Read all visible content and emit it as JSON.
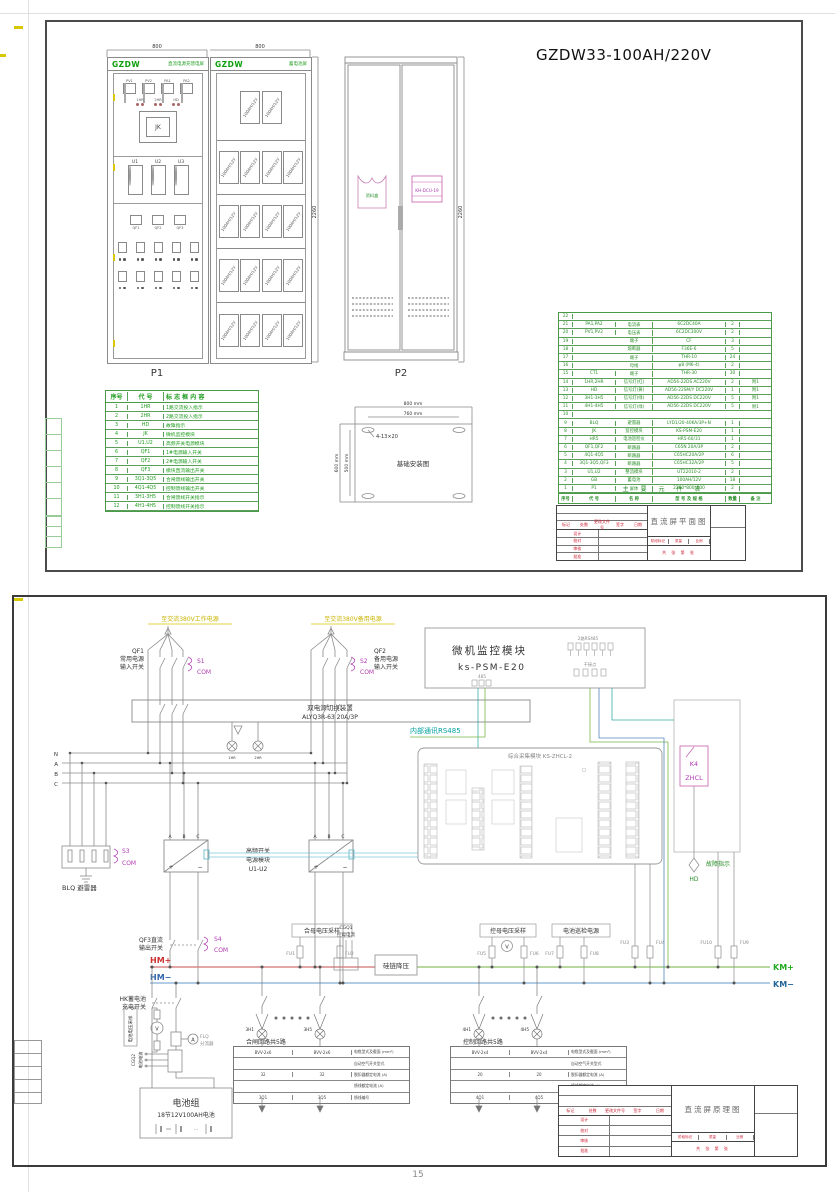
{
  "page": {
    "number": "15"
  },
  "tb_common": {
    "rev": [
      "标记",
      "处数",
      "更改文件号",
      "签字",
      "日期"
    ],
    "roles": [
      "设计",
      "校对",
      "审核",
      "批准"
    ],
    "stage": [
      "阶段标记",
      "质量",
      "比例"
    ],
    "sheets": "共 张  第 张"
  },
  "sheet1": {
    "main_title": "GZDW33-100AH/220V",
    "dim_800_left": "800",
    "dim_800_right": "800",
    "dim_2260_bat": "2260",
    "dim_2260_p2": "2260",
    "p1": {
      "brand": "GZDW",
      "header": "直流电源充馈电屏",
      "label": "P1",
      "meters": [
        "PV1",
        "PV2",
        "PA1",
        "PA2"
      ],
      "lamps": [
        "1HR",
        "2HR",
        "HD"
      ],
      "jk": "JK",
      "modules": [
        "U1",
        "U2",
        "U3"
      ],
      "breakers": [
        "QF1",
        "QF2",
        "QF3"
      ]
    },
    "bat": {
      "brand": "GZDW",
      "header": "蓄电池屏",
      "row1": [
        "100AH/12V",
        "100AH/12V"
      ],
      "row2": [
        "100AH/12V",
        "100AH/12V",
        "100AH/12V",
        "100AH/12V"
      ],
      "row3": [
        "100AH/12V",
        "100AH/12V",
        "100AH/12V",
        "100AH/12V"
      ],
      "row4": [
        "100AH/12V",
        "100AH/12V",
        "100AH/12V",
        "100AH/12V"
      ],
      "row5": [
        "100AH/12V",
        "100AH/12V",
        "100AH/12V",
        "100AH/12V"
      ]
    },
    "p2": {
      "label": "P2",
      "pocket": "资料盒",
      "dcu": "KH-DCU-19"
    },
    "marking": {
      "headers": [
        "序号",
        "代 号",
        "标 志 框 内 容"
      ],
      "rows": [
        {
          "n": "1",
          "c": "1HR",
          "d": "1路交流投入指示"
        },
        {
          "n": "2",
          "c": "2HR",
          "d": "2路交流投入指示"
        },
        {
          "n": "3",
          "c": "HD",
          "d": "故障指示"
        },
        {
          "n": "4",
          "c": "JK",
          "d": "微机监控模块"
        },
        {
          "n": "5",
          "c": "U1,U2",
          "d": "高频开关电源模块"
        },
        {
          "n": "6",
          "c": "QF1",
          "d": "1#电源输入开关"
        },
        {
          "n": "7",
          "c": "QF2",
          "d": "2#电源输入开关"
        },
        {
          "n": "8",
          "c": "QF3",
          "d": "模块直流输出开关"
        },
        {
          "n": "9",
          "c": "3Q1-3Q5",
          "d": "合闸馈线输出开关"
        },
        {
          "n": "10",
          "c": "4Q1-4Q5",
          "d": "控制馈线输出开关"
        },
        {
          "n": "11",
          "c": "3H1-3H5",
          "d": "合闸馈线开关指示"
        },
        {
          "n": "12",
          "c": "4H1-4H5",
          "d": "控制馈线开关指示"
        }
      ]
    },
    "foundation": {
      "title": "基础安装图",
      "d1": "800 mm",
      "d2": "760 mm",
      "d3": "600 mm",
      "d4": "500 mm",
      "callout": "4-13×20"
    },
    "parts": {
      "caption": "主 要 元 件 表",
      "headers": [
        "序号",
        "代  号",
        "名  称",
        "型 号 及 规 格",
        "数量",
        "备 注"
      ],
      "rows": [
        {
          "n": "22",
          "c": "",
          "m": "",
          "t": "",
          "q": "",
          "r": ""
        },
        {
          "n": "21",
          "c": "PA1,PA2",
          "m": "电流表",
          "t": "6C2DC40A",
          "q": "2",
          "r": ""
        },
        {
          "n": "20",
          "c": "PV1,PV2",
          "m": "电压表",
          "t": "6C2DC300V",
          "q": "2",
          "r": ""
        },
        {
          "n": "19",
          "c": "",
          "m": "端子",
          "t": "CF",
          "q": "3",
          "r": ""
        },
        {
          "n": "18",
          "c": "",
          "m": "熔断器",
          "t": "F36E-6",
          "q": "5",
          "r": ""
        },
        {
          "n": "17",
          "c": "",
          "m": "端子",
          "t": "THR-10",
          "q": "24",
          "r": ""
        },
        {
          "n": "16",
          "c": "",
          "m": "母线",
          "t": "φ8 (M6-4)",
          "q": "2",
          "r": ""
        },
        {
          "n": "15",
          "c": "CT1",
          "m": "端子",
          "t": "THR-30",
          "q": "30",
          "r": ""
        },
        {
          "n": "14",
          "c": "1HR,2HR",
          "m": "信号灯(红)",
          "t": "AD56-22DS AC220V",
          "q": "2",
          "r": "附1"
        },
        {
          "n": "13",
          "c": "HD",
          "m": "信号灯(黄)",
          "t": "AD56-22SM/Y DC220V",
          "q": "1",
          "r": "附1"
        },
        {
          "n": "12",
          "c": "3H1-3H5",
          "m": "信号灯(绿)",
          "t": "AD56-22DS DC220V",
          "q": "5",
          "r": "附1"
        },
        {
          "n": "11",
          "c": "4H1-4H5",
          "m": "信号灯(绿)",
          "t": "AD56-22DS DC220V",
          "q": "5",
          "r": "附1"
        },
        {
          "n": "10",
          "c": "",
          "m": "",
          "t": "",
          "q": "",
          "r": ""
        },
        {
          "n": "9",
          "c": "BLQ",
          "m": "避雷器",
          "t": "LYD1/20-40KA/3P+N",
          "q": "1",
          "r": ""
        },
        {
          "n": "8",
          "c": "JK",
          "m": "监控模块",
          "t": "KS-PSM-E20",
          "q": "1",
          "r": ""
        },
        {
          "n": "7",
          "c": "HR5",
          "m": "电池巡检仪",
          "t": "HR5-60/31",
          "q": "1",
          "r": ""
        },
        {
          "n": "6",
          "c": "QF1,QF2",
          "m": "断路器",
          "t": "C65N 20A/3P",
          "q": "2",
          "r": ""
        },
        {
          "n": "5",
          "c": "4Q1-4Q5",
          "m": "断路器",
          "t": "C65HC20A/2P",
          "q": "6",
          "r": ""
        },
        {
          "n": "4",
          "c": "3Q1-3Q5,QF3",
          "m": "断路器",
          "t": "C65HC32A/2P",
          "q": "5",
          "r": ""
        },
        {
          "n": "3",
          "c": "U1,U2",
          "m": "整流模块",
          "t": "UT22010-2",
          "q": "2",
          "r": ""
        },
        {
          "n": "2",
          "c": "GB",
          "m": "蓄电池",
          "t": "100AH/12V",
          "q": "18",
          "r": ""
        },
        {
          "n": "1",
          "c": "P1",
          "m": "屏体",
          "t": "2260*800*600",
          "q": "2",
          "r": ""
        }
      ]
    },
    "tb": {
      "title": "直流屏平面图"
    }
  },
  "sheet2": {
    "ac1": "至交流380V工作电源",
    "ac2": "至交流380V备用电源",
    "qf1": [
      "QF1",
      "常用电源",
      "输入开关"
    ],
    "qf2": [
      "QF2",
      "备用电源",
      "输入开关"
    ],
    "s1": "S1",
    "s2": "S2",
    "s3": "S3",
    "s4": "S4",
    "com": "COM",
    "ats1": "双电源切换装置",
    "ats2": "ALYQ3R-63 20A/3P",
    "atslamps": [
      "1HR",
      "2HR"
    ],
    "nabc": [
      "N",
      "A",
      "B",
      "C"
    ],
    "abc": [
      "A",
      "B",
      "C"
    ],
    "plus": "+",
    "minus": "−",
    "blq": "BLQ 避雷器",
    "rect": [
      "高频开关",
      "电源模块",
      "U1-U2"
    ],
    "qf3": [
      "QF3直流",
      "输出开关"
    ],
    "hm_p": "HM+",
    "hm_m": "HM−",
    "km_p": "KM+",
    "km_m": "KM−",
    "hemu": "合母电压采样",
    "fu1": "FU1",
    "fu2": "FU2",
    "fu3": "FU3",
    "fu4": "FU4",
    "fu5": "FU5",
    "fu6": "FU6",
    "fu7": "FU7",
    "fu8": "FU8",
    "fu9": "FU9",
    "fu10": "FU10",
    "cgq1": [
      "CGQ1",
      "控母电流"
    ],
    "gui": "硅链降压",
    "kongmu": "控母电压采样",
    "v": "V",
    "a": "A",
    "xunjian": "电池巡检电源",
    "hk": [
      "HK蓄电池",
      "充电开关"
    ],
    "batv": "电池电压采样",
    "cgq2": [
      "CGQ2",
      "电池电流"
    ],
    "flq": [
      "FLQ",
      "分流器"
    ],
    "battery": [
      "电池组",
      "18节12V100AH电池"
    ],
    "mon": {
      "t1": "微机监控模块",
      "t2": "ks-PSM-E20",
      "g1": "2路RS485",
      "g2": "干接点",
      "g3": "485"
    },
    "rs485": "内部通讯RS485",
    "zh": "综合采集模块 KS-ZHCL-2",
    "k4": "K4",
    "zhcl": "ZHCL",
    "fault": [
      "故障指示",
      "HD"
    ],
    "grp1": {
      "title": "合闸回路共5路",
      "l1": "3H1",
      "l2": "3H5",
      "rows": [
        [
          "BVV-2x6",
          "BVV-2x6",
          "电缆型式及截面 (mm²)"
        ],
        [
          "",
          "",
          "自动空气开关型式"
        ],
        [
          "32",
          "32",
          "脱扣器额定电流 (A)"
        ],
        [
          "",
          "",
          "馈线额定电流 (A)"
        ],
        [
          "3Q1",
          "3Q5",
          "馈线编号"
        ]
      ]
    },
    "grp2": {
      "title": "控制回路共5路",
      "l1": "4H1",
      "l2": "4H5",
      "rows": [
        [
          "BVV-2x4",
          "BVV-2x4",
          "电缆型式及截面 (mm²)"
        ],
        [
          "",
          "",
          "自动空气开关型式"
        ],
        [
          "20",
          "20",
          "脱扣器额定电流 (A)"
        ],
        [
          "",
          "",
          "馈线额定电流 (A)"
        ],
        [
          "4Q1",
          "4Q5",
          "馈线编号"
        ]
      ]
    },
    "tb": {
      "title": "直流屏原理图"
    }
  }
}
